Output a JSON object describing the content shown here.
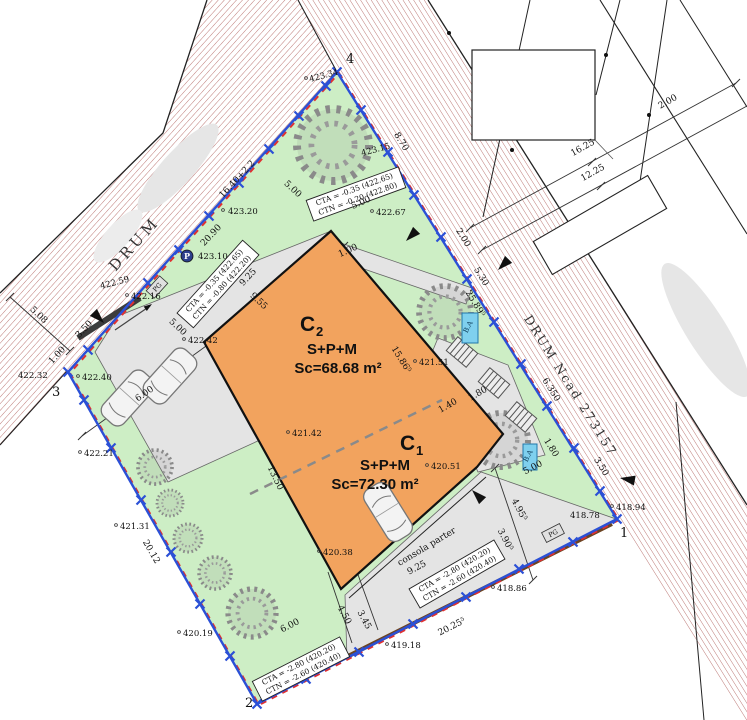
{
  "colors": {
    "boundary": "#2b50d6",
    "hatch": "#a0403c",
    "building": "#f2a35e",
    "green": "#cdeec5",
    "paved": "#e4e4e4",
    "basin_blue": "#7fd0ee",
    "wall_brown": "#6b4423",
    "dash_red": "#e03030"
  },
  "buildings": {
    "c2": {
      "letter": "C",
      "index": "2",
      "regime": "S+P+M",
      "area": "Sc=68.68 m²"
    },
    "c1": {
      "letter": "C",
      "index": "1",
      "regime": "S+P+M",
      "area": "Sc=72.30 m²"
    }
  },
  "roads": {
    "left": "DRUM",
    "right": "DRUM Ncad 273157"
  },
  "vertices": {
    "v1": "1",
    "v2": "2",
    "v3": "3",
    "v4": "4"
  },
  "levels": {
    "top": {
      "l1": "CTA = -0.35 (422.65)",
      "l2": "CTN = -0.20 (422.80)"
    },
    "left": {
      "l1": "CTA = -0.35 (422.65)",
      "l2": "CTN = -0.80 (422.20)"
    },
    "bottom_left": {
      "l1": "CTA = -2.80 (420.20)",
      "l2": "CTN = -2.60 (420.40)"
    },
    "bottom_right": {
      "l1": "CTA = -2.80 (420.20)",
      "l2": "CTN = -2.60 (420.40)"
    }
  },
  "dims": {
    "d870": "8.70",
    "d200": "2.00",
    "d530": "5.30",
    "d25895": "25.89⁵",
    "d6350": "6.350",
    "d350": "3.50",
    "d180": "1.80",
    "d1640": "16.40+2.2",
    "d2090": "20.90",
    "d925": "9.25",
    "d955": "9.55",
    "d500": "5.00",
    "d100": "1.00",
    "d508": "5.08",
    "d600": "6.00",
    "d2012": "20.12",
    "d1350": "13.50",
    "d15865": "15.86⁵",
    "d140": "1.40",
    "d450": "4.50",
    "d345": "3.45",
    "d3905": "3.90⁵",
    "d4955": "4.95⁵",
    "d20255": "20.25⁵",
    "d1625": "16.25",
    "d1225": "12.25"
  },
  "elevations": {
    "e42334": "423.34",
    "e42315": "423.15",
    "e42320": "423.20",
    "e42310": "423.10",
    "e42267": "422.67",
    "e42259": "422.59",
    "e42242": "422.42",
    "e42240": "422.40",
    "e42232": "422.32",
    "e42221": "422.21",
    "e42216": "422.16",
    "e42151": "421.51",
    "e42142": "421.42",
    "e42131": "421.31",
    "e42051": "420.51",
    "e42038": "420.38",
    "e42019": "420.19",
    "e41918": "419.18",
    "e41886": "418.86",
    "e41894": "418.94",
    "e41878": "418.78"
  },
  "annotations": {
    "consola": "consola parter",
    "basin": "B.A",
    "gate": "PG",
    "pole": "P"
  }
}
